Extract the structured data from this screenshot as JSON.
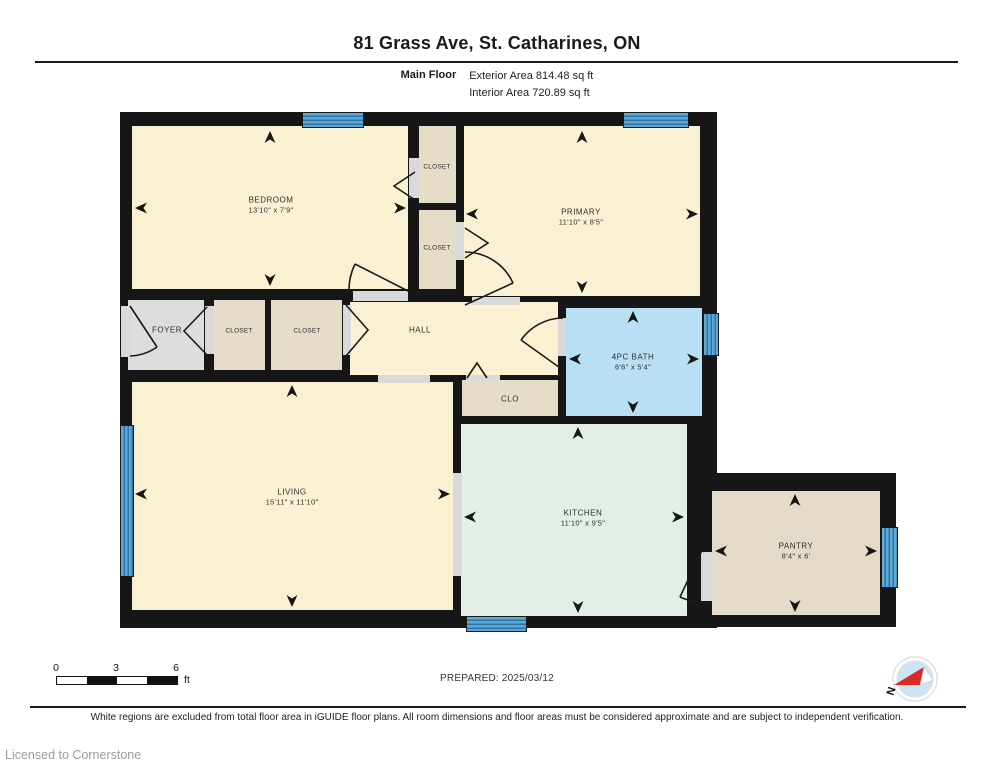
{
  "header": {
    "title": "81 Grass Ave, St. Catharines, ON",
    "floor_label": "Main Floor",
    "exterior_area": "Exterior Area 814.48 sq ft",
    "interior_area": "Interior Area 720.89 sq ft"
  },
  "rooms": {
    "bedroom": {
      "name": "BEDROOM",
      "dims": "13'10\" x 7'9\""
    },
    "closet_top_1": {
      "name": "CLOSET"
    },
    "closet_top_2": {
      "name": "CLOSET"
    },
    "primary": {
      "name": "PRIMARY",
      "dims": "11'10\" x 8'5\""
    },
    "foyer": {
      "name": "FOYER"
    },
    "closet_mid_1": {
      "name": "CLOSET"
    },
    "closet_mid_2": {
      "name": "CLOSET"
    },
    "hall": {
      "name": "HALL"
    },
    "bath": {
      "name": "4PC BATH",
      "dims": "6'6\" x 5'4\""
    },
    "clo": {
      "name": "CLO"
    },
    "living": {
      "name": "LIVING",
      "dims": "15'11\" x 11'10\""
    },
    "kitchen": {
      "name": "KITCHEN",
      "dims": "11'10\" x 9'5\""
    },
    "pantry": {
      "name": "PANTRY",
      "dims": "8'4\" x 6'"
    }
  },
  "scale_bar": {
    "ticks": [
      "0",
      "3",
      "6"
    ],
    "unit": "ft"
  },
  "compass": {
    "label": "N"
  },
  "footer": {
    "prepared": "PREPARED: 2025/03/12",
    "disclaimer": "White regions are excluded from total floor area in iGUIDE floor plans. All room dimensions and floor areas must be considered approximate and are subject to independent verification.",
    "license": "Licensed to Cornerstone"
  },
  "colors": {
    "wall": "#161616",
    "window_blue": "#5FA8D6",
    "room_cream": "#FAF1D2",
    "room_tan": "#E6DDC9",
    "room_gray": "#DDDDDD",
    "bath_blue": "#B9DFF4",
    "kitchen_mint": "#E3EEE6",
    "pantry_beige": "#E3DAC7",
    "compass_red": "#D92B21"
  }
}
